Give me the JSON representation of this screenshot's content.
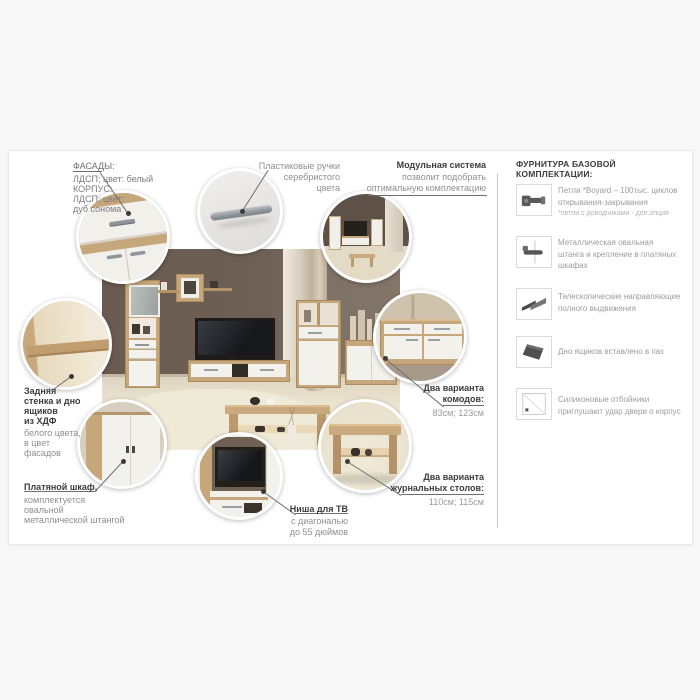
{
  "colors": {
    "wood": "#c6a77b",
    "wall": "#6a5c51",
    "dark_text": "#3c3c3c",
    "gray_text": "#8f8f8f",
    "carpet": "#e6dfcb"
  },
  "callouts": {
    "facades": {
      "title": "ФАСАДЫ:",
      "body": "ЛДСП; цвет: белый\nКОРПУС:\nЛДСП; цвет:\nдуб сонома"
    },
    "handles": {
      "body": "Пластиковые ручки\nсеребристого\nцвета"
    },
    "modular": {
      "title": "Модульная система",
      "body": "позволит подобрать\nоптимальную комплектацию"
    },
    "back_panel": {
      "title": "Задняя\nстенка и дно\nящиков\nиз ХДФ",
      "body": "белого цвета,\nв цвет\nфасадов"
    },
    "wardrobe": {
      "title": "Платяной шкаф,",
      "body": "комплектуется\nовальной\nметаллической штангой"
    },
    "tv_niche": {
      "title": "Ниша для ТВ",
      "body": "с диагональю\nдо 55 дюймов"
    },
    "dressers": {
      "title": "Два варианта\nкомодов:",
      "value": "83см; 123см"
    },
    "coffee_tables": {
      "title": "Два варианта\nжурнальных столов:",
      "value": "110см; 115см"
    }
  },
  "hardware": {
    "header": "ФУРНИТУРА БАЗОВОЙ КОМПЛЕКТАЦИИ:",
    "items": [
      {
        "icon": "hinge-icon",
        "text": "Петли *Boyard – 100тыс. циклов\nоткрывания-закрывания",
        "note": "*петли с доводчиками - доп.опция"
      },
      {
        "icon": "wardrobe-rod-icon",
        "text": "Металлическая овальная\nштанга и крепление в платяных\nшкафах"
      },
      {
        "icon": "telescopic-slide-icon",
        "text": "Телескопические направляющие\nполного выдвижения"
      },
      {
        "icon": "drawer-bottom-icon",
        "text": "Дно ящиков вставлено в паз"
      },
      {
        "icon": "silicone-bumper-icon",
        "text": "Силиконовые отбойники\nприглушают удар двери о корпус"
      }
    ]
  }
}
